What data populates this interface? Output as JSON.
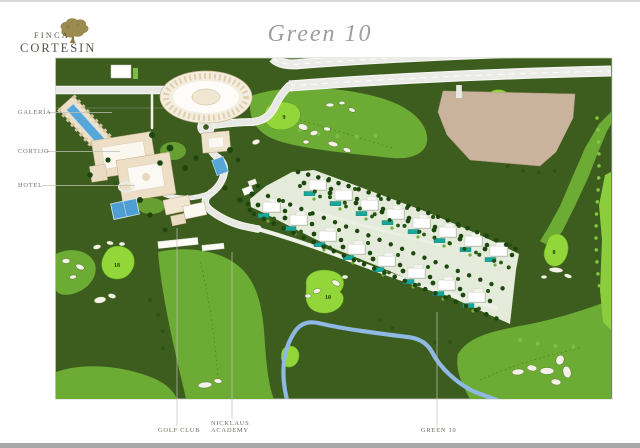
{
  "logo": {
    "line1": "FINCA",
    "line2": "CORTESIN"
  },
  "title": "Green 10",
  "side_labels": {
    "galeria": "GALERÍA",
    "cortijo": "CORTIJO",
    "hotel": "HOTEL"
  },
  "bottom_labels": {
    "golf_club": "GOLF CLUB",
    "academy_line1": "NICKLAUS",
    "academy_line2": "ACADEMY",
    "green_10": "GREEN 10"
  },
  "hole_numbers": {
    "hole9": "9",
    "hole18": "18",
    "hole10": "10",
    "hole8": "8"
  },
  "map_colors": {
    "rough_dark_green": "#3c5d1e",
    "fairway_green": "#6cab34",
    "putting_green": "#92d639",
    "bunker_sand": "#f4f2e6",
    "water_stream": "#8fb8e3",
    "road_grey": "#e8e8e4",
    "development_plot_beige": "#c9b39c",
    "hotel_pool_blue": "#57a6d8",
    "villa_pool_teal": "#19a79b",
    "building_cream": "#ecdfc6"
  }
}
